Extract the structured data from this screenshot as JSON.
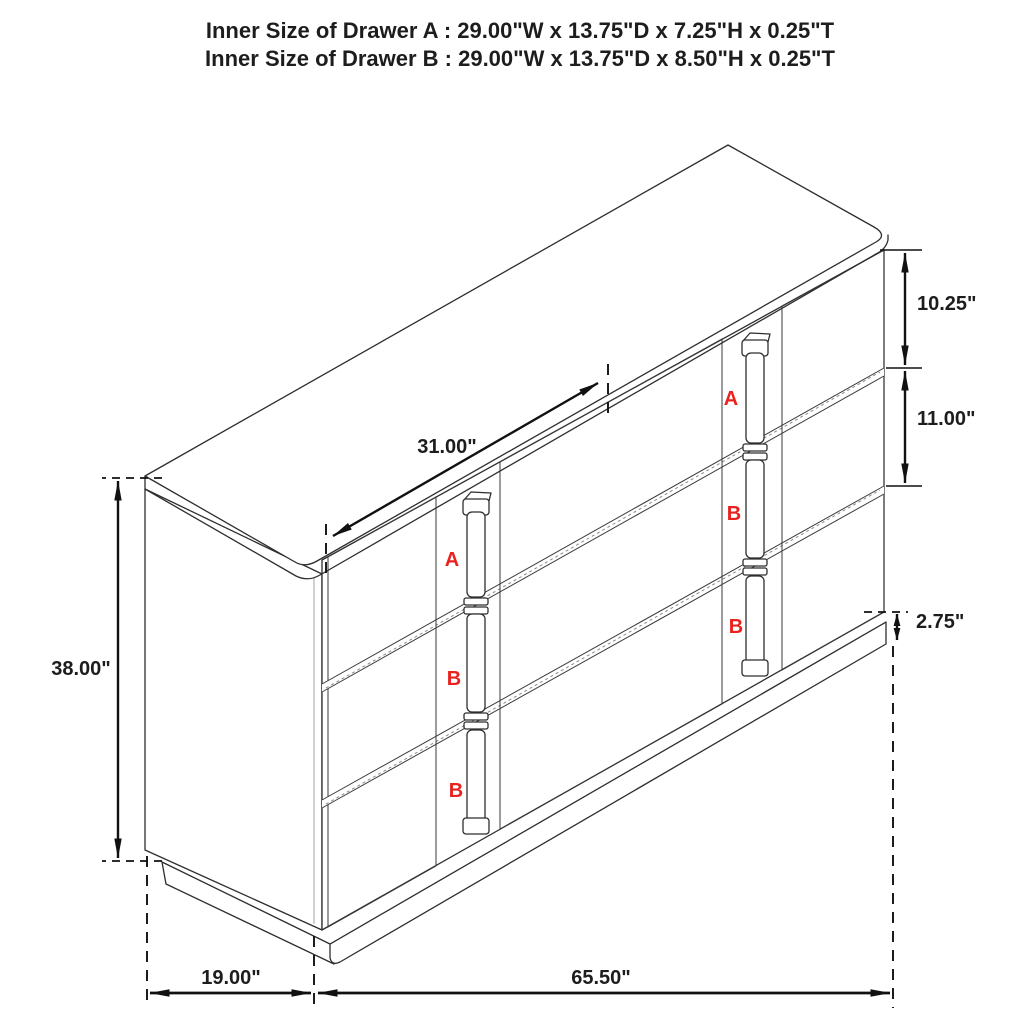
{
  "title": {
    "line1": "Inner Size of Drawer A : 29.00\"W x 13.75\"D x 7.25\"H x 0.25\"T",
    "line2": "Inner Size of Drawer B : 29.00\"W x 13.75\"D x 8.50\"H x 0.25\"T"
  },
  "dimensions": {
    "overall_height": "38.00\"",
    "depth": "19.00\"",
    "overall_width": "65.50\"",
    "middle_section_width": "31.00\"",
    "top_drawer_front_height": "10.25\"",
    "middle_drawer_front_height": "11.00\"",
    "base_height": "2.75\""
  },
  "drawer_labels": {
    "left_column": [
      "A",
      "B",
      "B"
    ],
    "right_column": [
      "A",
      "B",
      "B"
    ]
  },
  "colors": {
    "label_red": "#e8231f",
    "line_color": "#2e2e2e",
    "background": "#ffffff"
  }
}
